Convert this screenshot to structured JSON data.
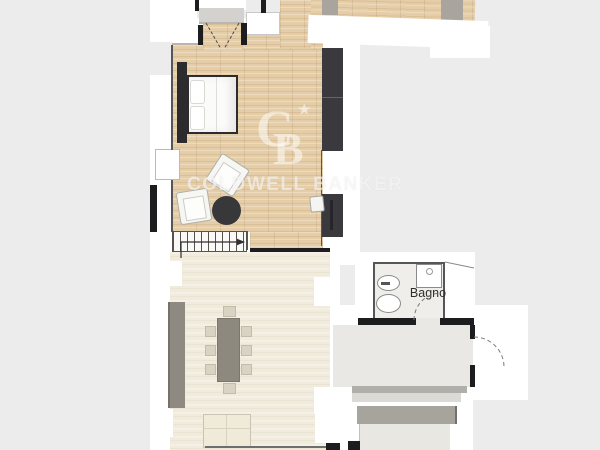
{
  "title": "Apartment floor plan",
  "watermark": {
    "brand": "COLDWELL BANKER",
    "logo": {
      "letter_c": "C",
      "letter_b": "B",
      "star": "★"
    }
  },
  "labels": {
    "bathroom": "Bagno"
  },
  "palette": {
    "background": "#ececec",
    "paper": "#ffffff",
    "wood_floor": "#e5cda7",
    "cream_floor": "#f0ebdc",
    "corridor_floor": "#e9e8e4",
    "dark_furniture": "#3a3a3e",
    "gray_furniture": "#8e8a81",
    "wall": "#1d1d1f",
    "watermark": "rgba(255,255,255,0.55)"
  }
}
